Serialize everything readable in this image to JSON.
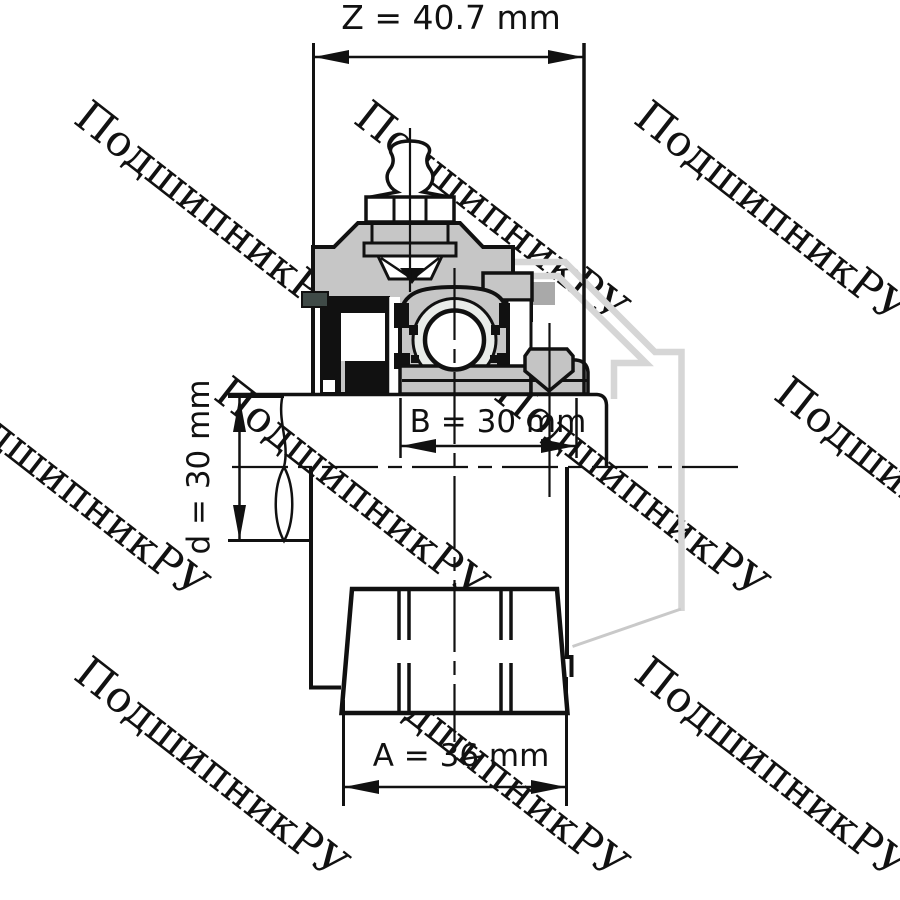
{
  "watermark": {
    "text": "ПодшипникРУ",
    "color": "#e3e3e3",
    "angle_deg": 38
  },
  "dimensions": {
    "Z": {
      "label": "Z = 40.7 mm",
      "letter": "Z",
      "value": 40.7,
      "unit": "mm",
      "orientation": "horizontal-top"
    },
    "B": {
      "label": "B = 30 mm",
      "letter": "B",
      "value": 30,
      "unit": "mm",
      "orientation": "horizontal-middle"
    },
    "d": {
      "label": "d = 30 mm",
      "letter": "d",
      "value": 30,
      "unit": "mm",
      "orientation": "vertical-left"
    },
    "A": {
      "label": "A = 36 mm",
      "letter": "A",
      "value": 36,
      "unit": "mm",
      "orientation": "horizontal-bottom"
    }
  },
  "colors": {
    "background": "#ffffff",
    "line": "#111111",
    "housing_gray": "#c6c6c6",
    "part_gray": "#c4c4c4",
    "band_gray": "#bfbfbf",
    "raceway_light": "#e9ece9",
    "phantom_gray": "#d6d6d6",
    "phantom_thin_gray": "#c9c9c9",
    "bolt_section_gray": "#a9a9a9",
    "slinger_dark": "#3f4a47"
  }
}
